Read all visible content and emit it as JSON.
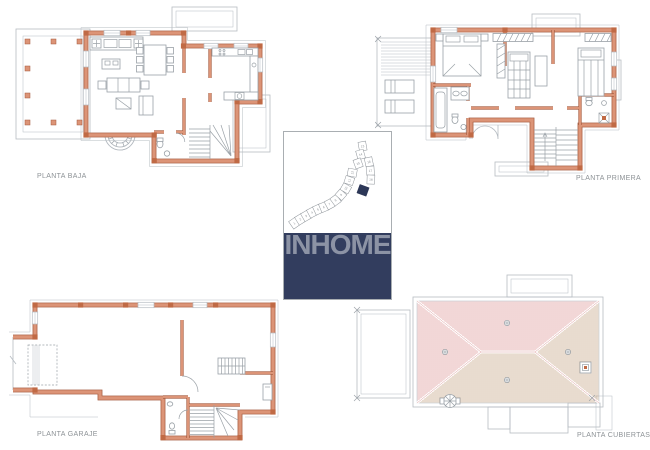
{
  "plans": {
    "baja": {
      "label": "PLANTA BAJA"
    },
    "primera": {
      "label": "PLANTA PRIMERA"
    },
    "garaje": {
      "label": "PLANTA GARAJE"
    },
    "cubiertas": {
      "label": "PLANTA CUBIERTAS"
    }
  },
  "logo": {
    "text": "INHOME"
  },
  "site_plan": {
    "plot_numbers": [
      "1",
      "2",
      "3",
      "4",
      "5",
      "6",
      "7",
      "8",
      "9",
      "10",
      "11",
      "12",
      "13",
      "14",
      "15",
      "16",
      "17",
      "18"
    ],
    "highlighted_plot": "selected villa plot"
  },
  "colors": {
    "wall_fill": "#dc9477",
    "wall_stroke": "#a3593c",
    "wall_corner": "#c06a45",
    "plan_gray": "#b6bcc2",
    "furniture_gray": "#9aa1a7",
    "roof_red": "#d98f8f",
    "roof_tan": "#c09a78",
    "label_gray": "#8d9296",
    "logo_band": "#323d5e",
    "logo_text": "#8c93a5",
    "site_highlight": "#2c3757",
    "card_border": "#a9aeb2"
  }
}
